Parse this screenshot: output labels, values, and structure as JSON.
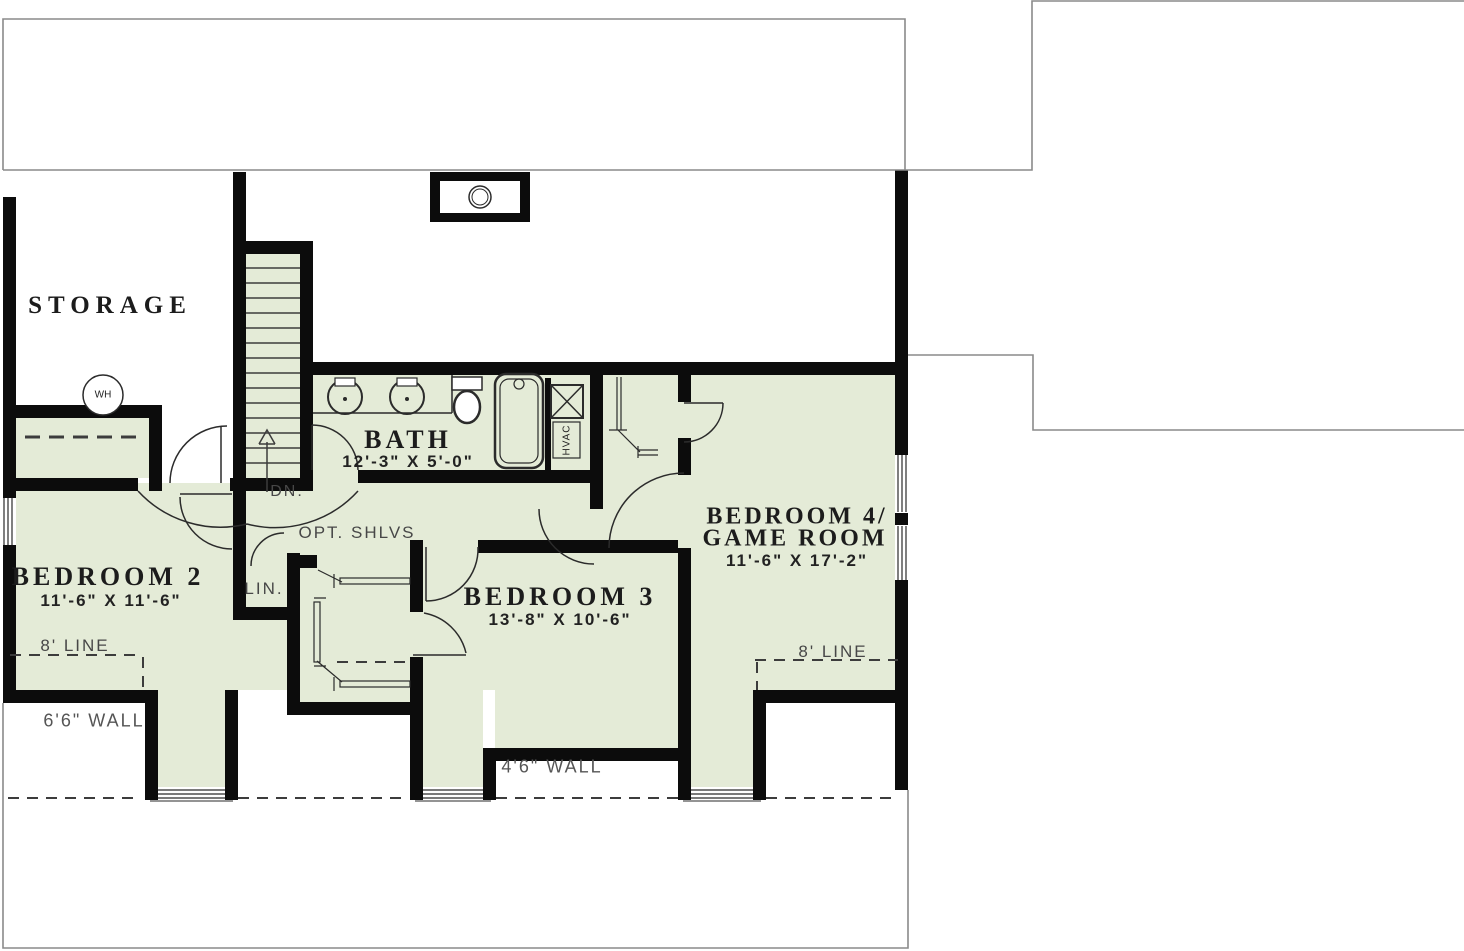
{
  "colors": {
    "room_fill": "#e4ebd7",
    "wall": "#0c0c0c",
    "outline": "#8a8a8a",
    "line_dark": "#3c3c3c",
    "label": "#1c1c1c",
    "annotation": "#474747"
  },
  "rooms": {
    "storage": {
      "label": "STORAGE"
    },
    "bath": {
      "label": "BATH",
      "dims": "12'-3\" X 5'-0\""
    },
    "bedroom2": {
      "label": "BEDROOM 2",
      "dims": "11'-6\" X 11'-6\""
    },
    "bedroom3": {
      "label": "BEDROOM 3",
      "dims": "13'-8\" X 10'-6\""
    },
    "bedroom4": {
      "label_line1": "BEDROOM 4/",
      "label_line2": "GAME ROOM",
      "dims": "11'-6\" X 17'-2\""
    },
    "linen": {
      "label": "LIN."
    }
  },
  "annotations": {
    "stairs_down": "DN.",
    "opt_shelves": "OPT. SHLVS",
    "ceiling_line_left": "8' LINE",
    "ceiling_line_right": "8' LINE",
    "knee_wall_left": "6'6\" WALL",
    "knee_wall_center": "4'6\" WALL",
    "water_heater": "WH",
    "hvac": "HVAC"
  }
}
